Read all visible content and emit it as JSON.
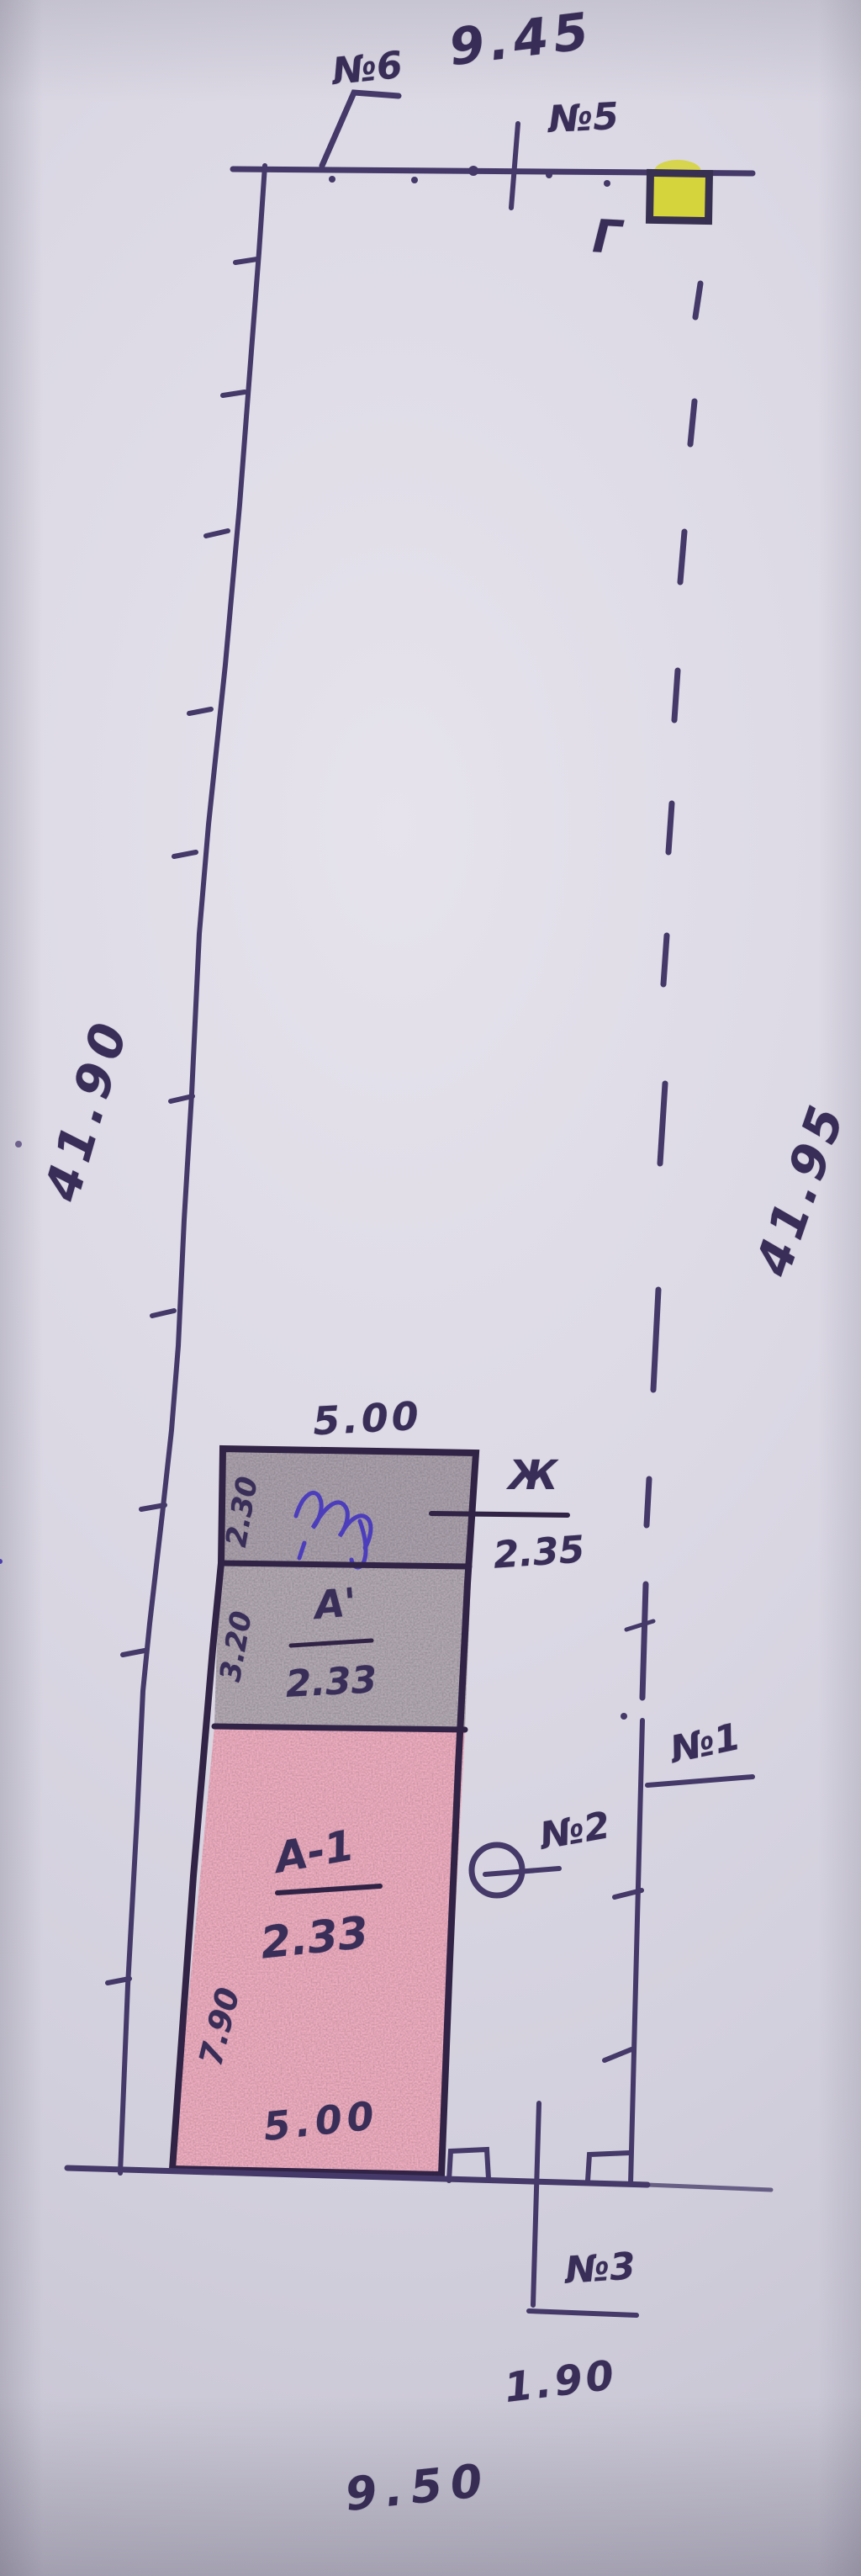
{
  "plan": {
    "dimensions": {
      "top_width": "9.45",
      "left_length": "41.90",
      "right_length": "41.95",
      "bottom_width": "9.50",
      "gate_width": "1.90"
    },
    "survey_points": {
      "p1": "№1",
      "p2": "№2",
      "p3": "№3",
      "p5": "№5",
      "p6": "№6"
    },
    "outbuilding_letter": "Г",
    "building": {
      "width_top": "5.00",
      "width_bottom": "5.00",
      "depth_left": "7.90",
      "sections": [
        {
          "label": "Ж",
          "value": "2.35",
          "side_depth": "2.30"
        },
        {
          "label": "А'",
          "value": "2.33",
          "side_depth": "3.20"
        },
        {
          "label": "А-1",
          "value": "2.33"
        }
      ]
    },
    "colors": {
      "ink": "#443968",
      "outline": "#302345",
      "pink_fill": "#f1b0c3",
      "gray_fill": "#b5acb6",
      "yellow_fill": "#d6d43c",
      "blue_ink": "#4334c0",
      "paper": "#d9d6e2"
    }
  }
}
